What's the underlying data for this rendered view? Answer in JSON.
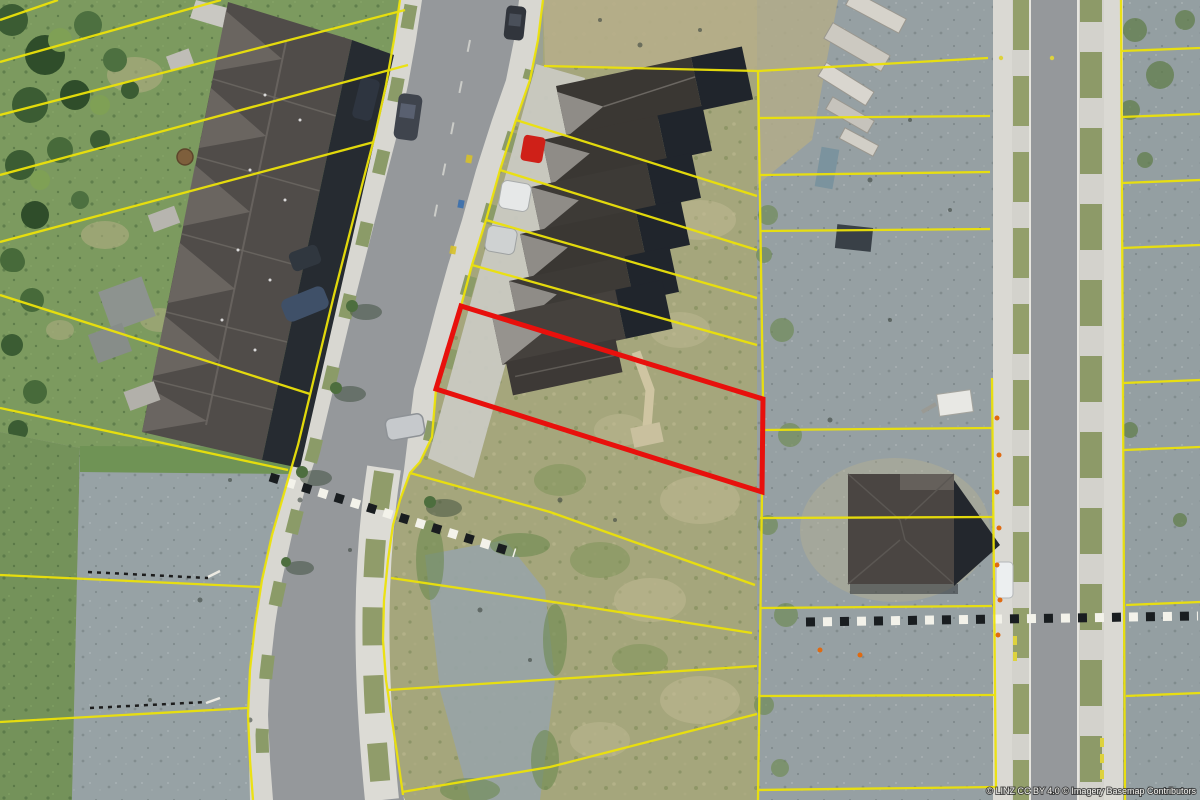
{
  "map": {
    "attribution": "© LINZ CC BY 4.0 © Imagery Basemap Contributors",
    "imagery_type": "aerial-orthophoto",
    "overlays": {
      "parcel_boundary": {
        "color": "#ece20a",
        "width_px": 2.3
      },
      "selected_parcel": {
        "color": "#e8100c",
        "width_px": 5
      }
    },
    "palette": {
      "grass": "#7c9a5f",
      "trees": "#3b5c33",
      "gravel": "#97a2a5",
      "scrub_dirt": "#a5a67c",
      "bare_dirt": "#b6ae8a",
      "road_asphalt": "#95989b",
      "sidewalk_concrete": "#dcdbd5",
      "roof_dark": "#4a4542",
      "roof_gable_light": "#8f8c87",
      "roof_shadow": "#20252c",
      "crosswalk_dark": "#191d20",
      "crosswalk_light": "#f3f2ea"
    },
    "features": [
      "townhouse-row-west",
      "townhouse-row-middle-under-construction",
      "selected-parcel-red",
      "vacant-lots-east",
      "construction-material-stacks",
      "curved-street-west",
      "straight-street-east",
      "single-house-east",
      "pedestrian-crossing-marks"
    ]
  }
}
